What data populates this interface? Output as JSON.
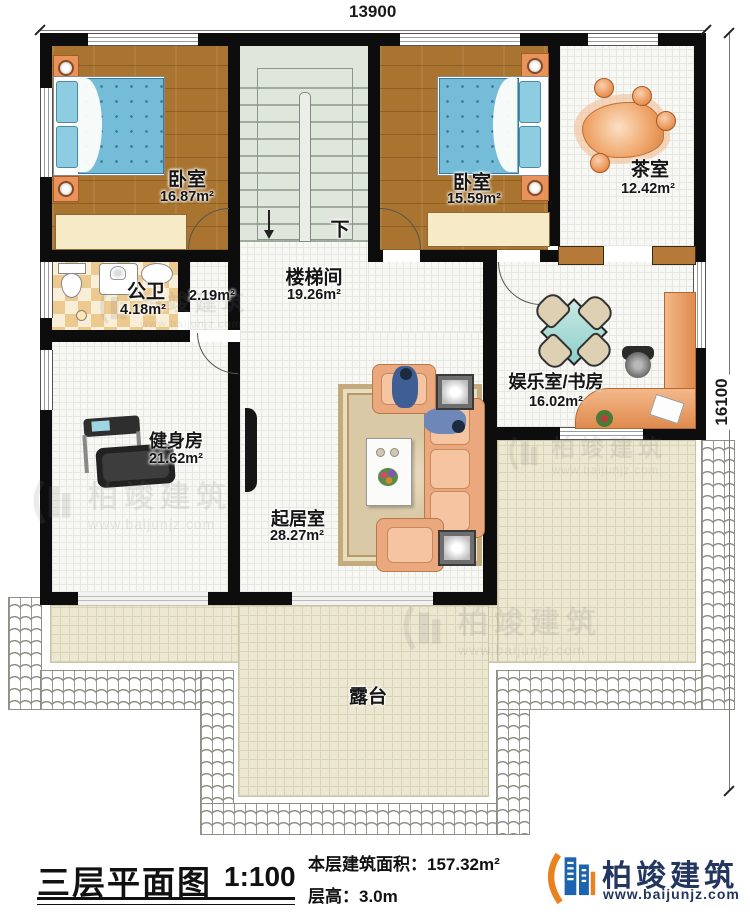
{
  "dimensions": {
    "top": "13900",
    "right": "16100"
  },
  "rooms": {
    "bedroom1": {
      "name": "卧室",
      "area": "16.87m²"
    },
    "bedroom2": {
      "name": "卧室",
      "area": "15.59m²"
    },
    "tea_room": {
      "name": "茶室",
      "area": "12.42m²"
    },
    "bathroom": {
      "name": "公卫",
      "area": "4.18m²"
    },
    "stairwell": {
      "name": "楼梯间",
      "area": "19.26m²"
    },
    "hallway": {
      "area": "2.19m²"
    },
    "gym": {
      "name": "健身房",
      "area": "21.62m²"
    },
    "living": {
      "name": "起居室",
      "area": "28.27m²"
    },
    "study": {
      "name": "娱乐室/书房",
      "area": "16.02m²"
    },
    "terrace": {
      "name": "露台"
    }
  },
  "stairs": {
    "down_label": "下"
  },
  "footer": {
    "title": "三层平面图",
    "scale": "1:100",
    "area_line": "本层建筑面积：157.32m²",
    "floor_height_line": "层高：3.0m",
    "brand": "柏竣建筑",
    "website": "www.baijunjz.com"
  },
  "watermark": {
    "brand": "柏竣建筑",
    "website": "www.baijunjz.com"
  },
  "icons": {
    "stair_direction": "down-arrow",
    "logo": "baijun-building-logo"
  },
  "colors": {
    "wall": "#0d0d0d",
    "wood_floor": "#a9742f",
    "terrace_floor": "#ece7d0",
    "stair_floor": "#dfe6dc",
    "bed_blue": "#74bcd8",
    "furniture_orange": "#e8935c",
    "logo_blue": "#1e63ae",
    "logo_orange": "#e8821e",
    "brand_navy": "#23365f"
  }
}
